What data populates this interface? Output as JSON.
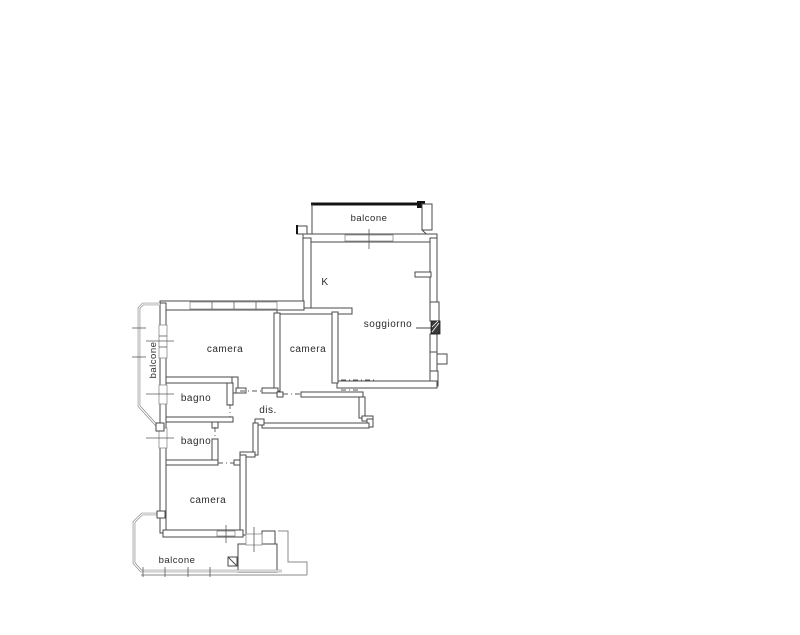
{
  "drawing_type": "apartment-floor-plan",
  "colors": {
    "background": "#ffffff",
    "wall_line": "#4a4a4a",
    "balcony_rail": "#8a8a8a",
    "top_rail_dark": "#141414",
    "label_text": "#2b2b2b"
  },
  "rooms": [
    {
      "id": "balcone-top",
      "label": "balcone"
    },
    {
      "id": "kitchen",
      "label": "K"
    },
    {
      "id": "soggiorno",
      "label": "soggiorno"
    },
    {
      "id": "camera-left",
      "label": "camera"
    },
    {
      "id": "camera-middle",
      "label": "camera"
    },
    {
      "id": "balcone-left",
      "label": "balcone"
    },
    {
      "id": "bagno-upper",
      "label": "bagno"
    },
    {
      "id": "disimpegno",
      "label": "dis."
    },
    {
      "id": "bagno-lower",
      "label": "bagno"
    },
    {
      "id": "camera-bottom",
      "label": "camera"
    },
    {
      "id": "balcone-bottom",
      "label": "balcone"
    }
  ]
}
